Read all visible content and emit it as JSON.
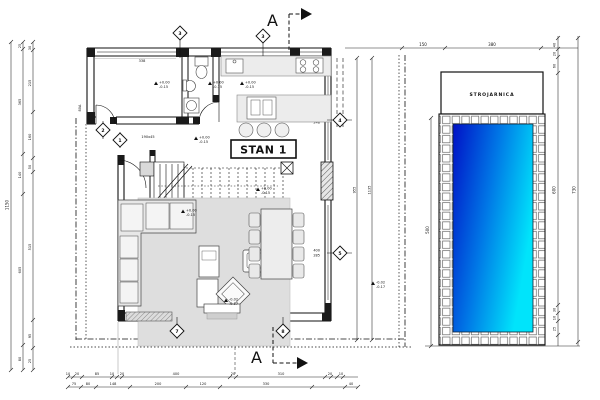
{
  "labels": {
    "apartment": "STAN 1",
    "pool_room": "STROJARNICA"
  },
  "section": {
    "top": "A",
    "bottom": "A"
  },
  "bubbles": {
    "top_left": "3",
    "top_right": "3",
    "entry_upper": "2",
    "entry_lower": "1",
    "right_upper": "4",
    "right_lower": "5",
    "bottom_left": "7",
    "bottom_right": "8"
  },
  "dims": {
    "left_total": "1150",
    "left_mid": [
      "25",
      "365",
      "140",
      "605",
      "80"
    ],
    "left_inner": [
      "30",
      "215",
      "160",
      "50",
      "515",
      "95",
      "25"
    ],
    "bottom_row1": [
      "10",
      "20",
      "85",
      "10",
      "20",
      "400",
      "20",
      "310",
      "20",
      "10"
    ],
    "bottom_row2": [
      "75",
      "80",
      "148",
      "200",
      "120",
      "330",
      "40"
    ],
    "pool_top": [
      "150",
      "380"
    ],
    "pool_left_width": "500",
    "pool_right": [
      "40",
      "20",
      "60",
      "600",
      "30",
      "10",
      "25"
    ],
    "pool_right_total": "730",
    "right_inner": "955",
    "right_outer": "1135",
    "opening_4": [
      "318",
      "248"
    ],
    "opening_5": [
      "400",
      "285"
    ],
    "bedroom_window": "338",
    "kitchen_note": "95",
    "hall_note": "190x45",
    "door_note": "80A"
  },
  "elev": [
    {
      "a": "+0.00",
      "b": "-0.15"
    },
    {
      "a": "+0.00",
      "b": "-0.15"
    },
    {
      "a": "+0.00",
      "b": "-0.15"
    },
    {
      "a": "+0.00",
      "b": "-0.15"
    },
    {
      "a": "+0.00",
      "b": "-0.15"
    },
    {
      "a": "+0.00",
      "b": "-0.15"
    },
    {
      "a": "-0.02",
      "b": "-0.17"
    },
    {
      "a": "-0.02",
      "b": "-0.17"
    }
  ]
}
